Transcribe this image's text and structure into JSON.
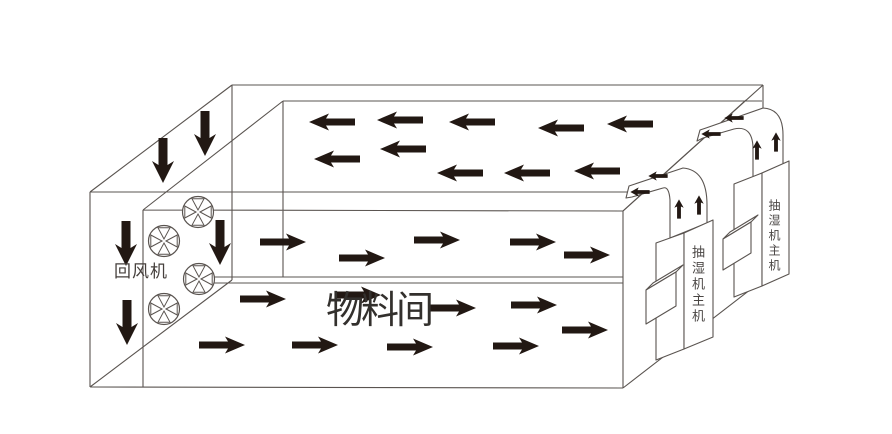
{
  "diagram": {
    "background": "#ffffff",
    "colors": {
      "line": "#5a5450",
      "arrow": "#221813",
      "label_dark": "#33302d",
      "label_gray": "#46403d",
      "unit_label": "#4a4644"
    },
    "labels": {
      "return_fan": {
        "text": "回风机",
        "color": "#46403d"
      },
      "material_room": {
        "text": "物料间",
        "color": "#33302d"
      },
      "dehumidifier_front": {
        "text": "抽湿机主机",
        "color": "#4a4644"
      },
      "dehumidifier_rear": {
        "text": "抽湿机主机",
        "color": "#4a4644"
      }
    },
    "fans": {
      "icon": "fan-icon",
      "positions": [
        [
          198,
          212
        ],
        [
          164,
          241
        ],
        [
          199,
          279
        ],
        [
          164,
          309
        ]
      ]
    },
    "airflow": {
      "down_large": [
        [
          163,
          160
        ],
        [
          205,
          133
        ],
        [
          126,
          243
        ],
        [
          127,
          322
        ],
        [
          220,
          242
        ]
      ],
      "left_ceiling": [
        [
          332,
          122
        ],
        [
          400,
          120
        ],
        [
          472,
          122
        ],
        [
          561,
          128
        ],
        [
          630,
          124
        ],
        [
          337,
          159
        ],
        [
          403,
          149
        ],
        [
          460,
          173
        ],
        [
          527,
          173
        ],
        [
          597,
          171
        ]
      ],
      "right_upper_level": [
        [
          283,
          242
        ],
        [
          362,
          258
        ],
        [
          437,
          240
        ],
        [
          533,
          242
        ],
        [
          587,
          255
        ]
      ],
      "right_lower_level": [
        [
          263,
          299
        ],
        [
          358,
          295
        ],
        [
          453,
          308
        ],
        [
          534,
          305
        ],
        [
          585,
          330
        ],
        [
          222,
          345
        ],
        [
          315,
          345
        ],
        [
          410,
          347
        ],
        [
          516,
          346
        ]
      ],
      "duct_left_small": [
        [
          658,
          176
        ],
        [
          640,
          192
        ],
        [
          734,
          118
        ],
        [
          711,
          134
        ]
      ],
      "duct_up_small": [
        [
          679,
          209
        ],
        [
          699,
          205
        ],
        [
          757,
          150
        ],
        [
          776,
          142
        ]
      ]
    }
  }
}
